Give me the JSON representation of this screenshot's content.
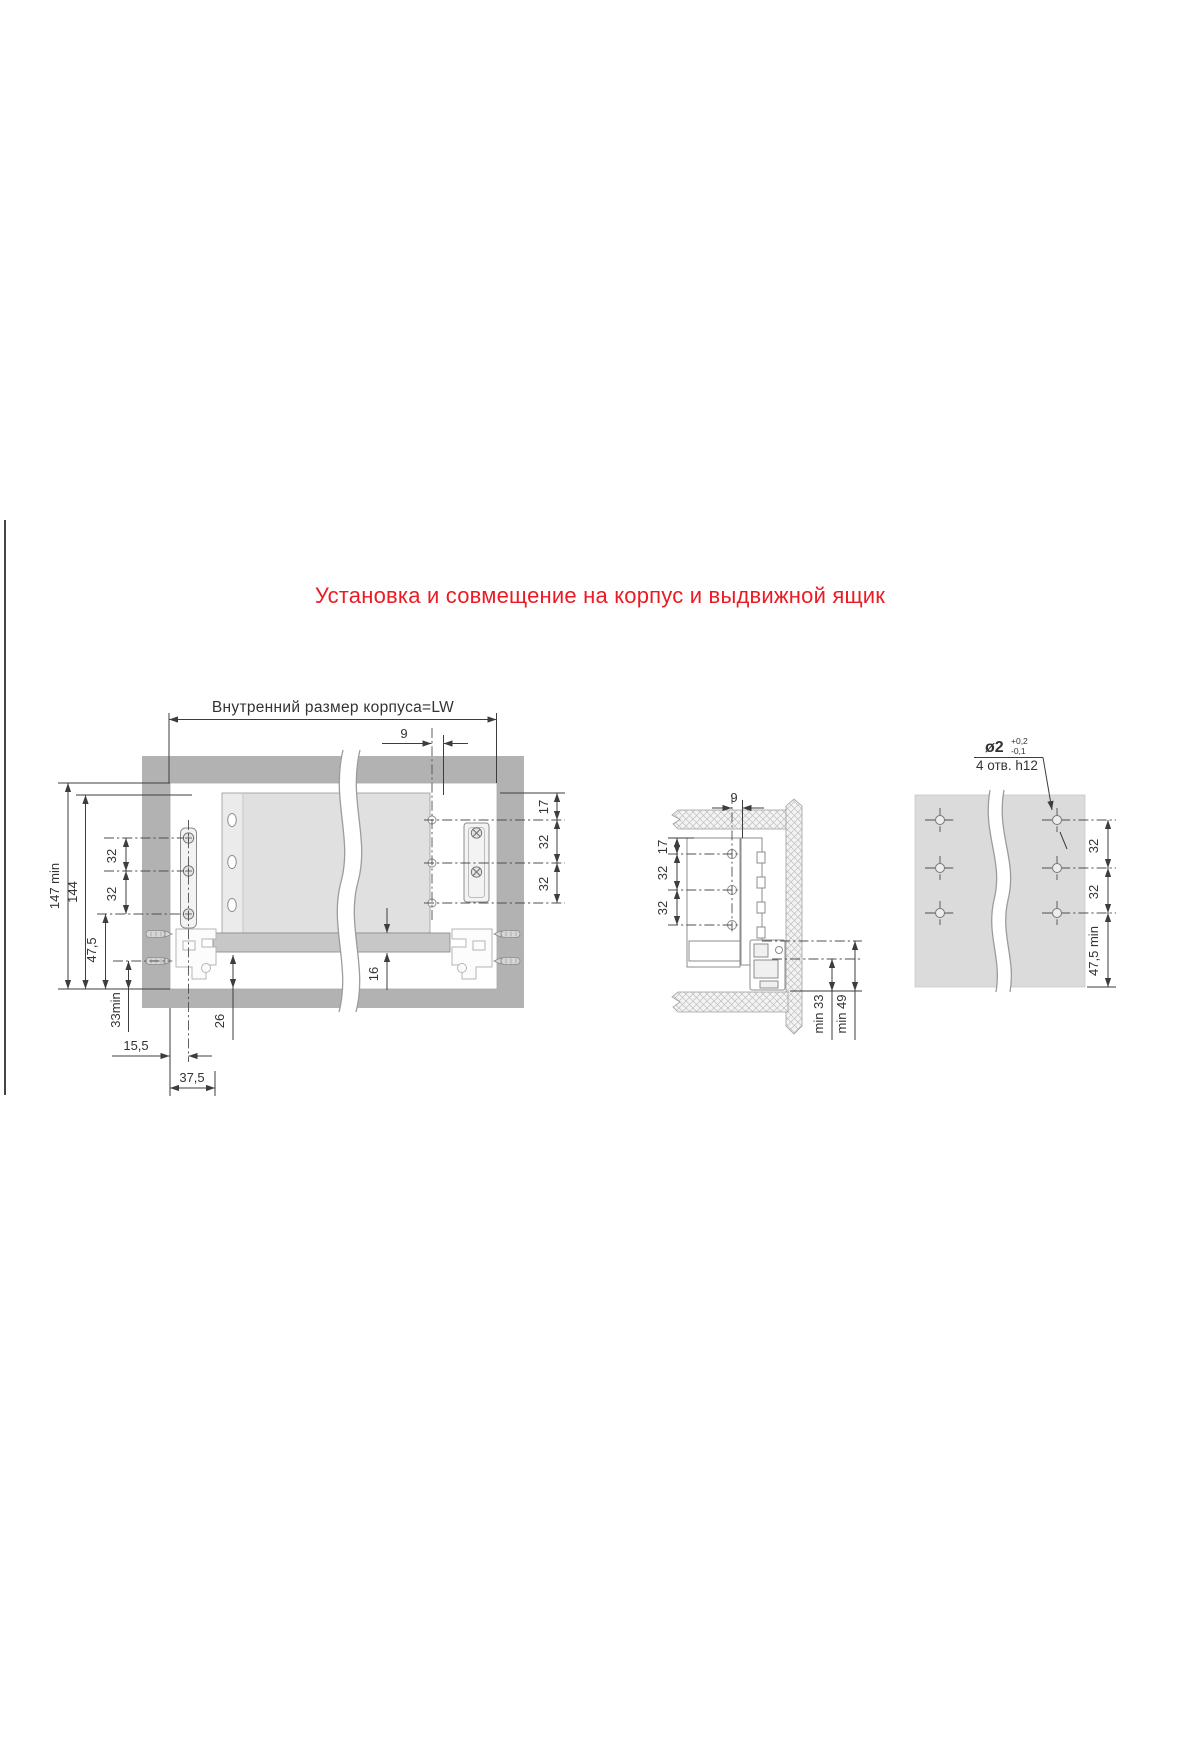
{
  "page": {
    "title": "Установка и совмещение на корпус и выдвижной ящик"
  },
  "colors": {
    "accent": "#ec1b23",
    "cabinet_gray": "#b2b2b2",
    "drawer_panel_gray": "#e0e0e0",
    "drawer_bottom_gray": "#c7c7c7",
    "drill_panel_gray": "#dbdbdb",
    "line": "#3d3d3d"
  },
  "front_view": {
    "dims": {
      "inner_width": "Внутренний размер корпуса=LW",
      "rear_hole_offset": "9",
      "inner_height_min": "147 min",
      "rail_height": "144",
      "hole_pitch_left_1": "32",
      "hole_pitch_left_2": "32",
      "bottom_hole_offset": "47,5",
      "bottom_clearance_min": "33min",
      "front_hole_offset": "15,5",
      "front_bracket_depth": "37,5",
      "bottom_gap": "26",
      "bottom_panel_thickness": "16",
      "top_hole_offset": "17",
      "hole_pitch_right_1": "32",
      "hole_pitch_right_2": "32"
    }
  },
  "section_view": {
    "dims": {
      "rear_hole_offset": "9",
      "top_hole_offset": "17",
      "hole_pitch_1": "32",
      "hole_pitch_2": "32",
      "bottom_min_1": "min 33",
      "bottom_min_2": "min 49"
    }
  },
  "drill_view": {
    "callout": {
      "diameter": "ø2",
      "tolerance_plus": "+0,2",
      "tolerance_minus": "-0,1",
      "holes_note": "4 отв. h12"
    },
    "dims": {
      "hole_pitch_1": "32",
      "hole_pitch_2": "32",
      "edge_offset_min": "47,5 min"
    }
  }
}
